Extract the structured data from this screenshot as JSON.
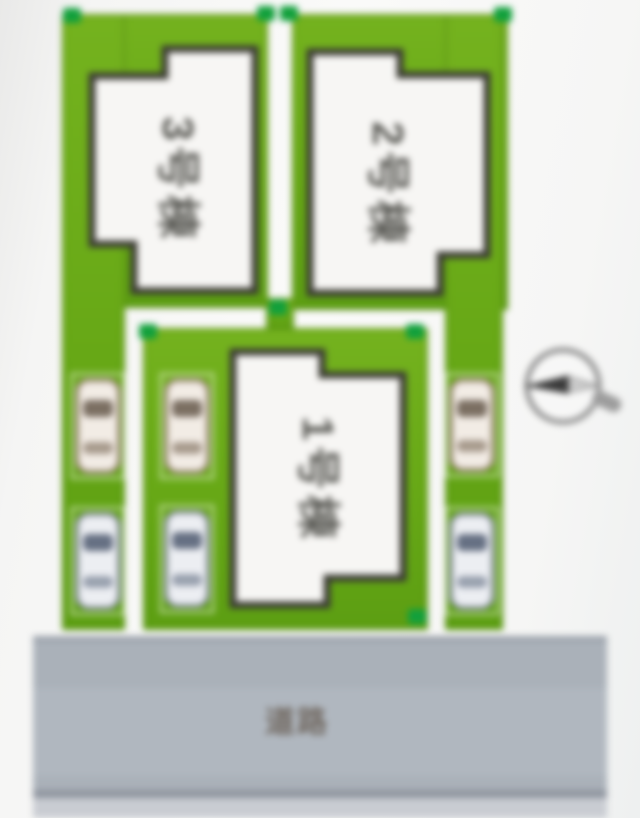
{
  "diagram": {
    "type": "residential-site-plan",
    "lots": [
      {
        "id": "3",
        "label": "3号棟"
      },
      {
        "id": "2",
        "label": "2号棟"
      },
      {
        "id": "1",
        "label": "1号棟"
      }
    ],
    "road_label": "道路",
    "icons": {
      "compass": "compass-icon (needle pointing left)",
      "car": "car-top-view-icon x6 (two parking spaces per lot)",
      "corner_marker": "green-survey-marker-dot x8"
    },
    "colors": {
      "lot_green": "#67a816",
      "marker_green": "#12a03c",
      "building_fill": "#f7f6f4",
      "building_outline": "#3b3b33",
      "road_gray": "#aab1b9",
      "road_curb": "#c9ccd2",
      "label_gray": "#5c5c57"
    }
  }
}
